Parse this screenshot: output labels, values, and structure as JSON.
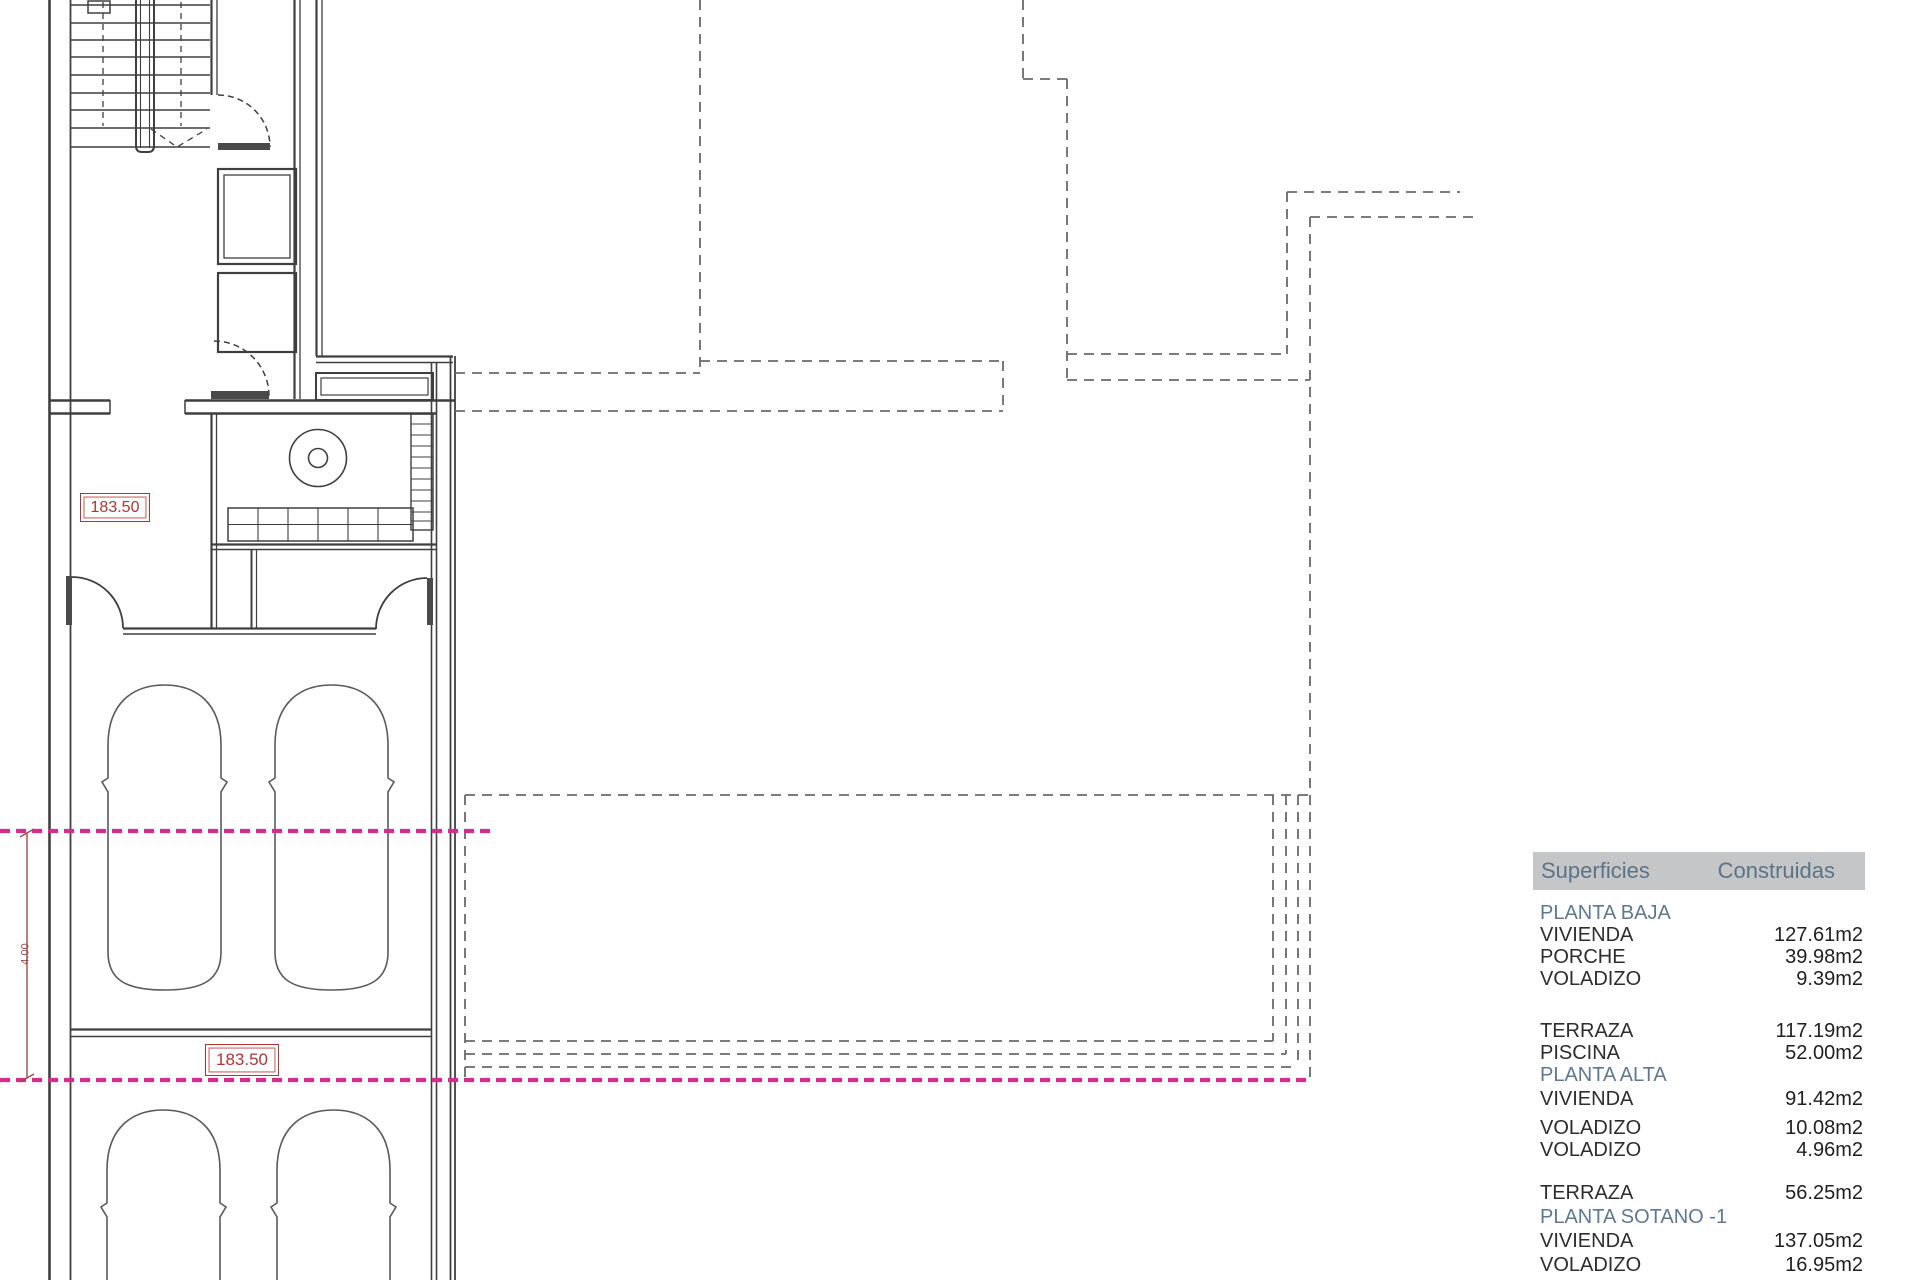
{
  "plan": {
    "labels": {
      "elevation_hall": "183.50",
      "elevation_garage": "183.50",
      "dimension_width": "4.00"
    },
    "colors": {
      "wall": "#3f3f3f",
      "dashed_outline": "#6a6a6a",
      "section_line_magenta": "#d92a8e",
      "annotation_red": "#b13434",
      "dimension_red": "#9a4b4b"
    }
  },
  "areas_table": {
    "header": {
      "surfaces": "Superficies",
      "built": "Construidas"
    },
    "style": {
      "header_bg": "#c5c6c8",
      "header_text": "#5d7286",
      "section_text": "#5f7892",
      "body_text": "#2d2d2d"
    },
    "rows": [
      {
        "type": "section",
        "label": "PLANTA BAJA"
      },
      {
        "type": "item",
        "label": "VIVIENDA",
        "value": "127.61m2"
      },
      {
        "type": "item",
        "label": "PORCHE",
        "value": "39.98m2"
      },
      {
        "type": "item",
        "label": "VOLADIZO",
        "value": "9.39m2"
      },
      {
        "type": "item",
        "label": "TERRAZA",
        "value": "117.19m2"
      },
      {
        "type": "item",
        "label": "PISCINA",
        "value": "52.00m2"
      },
      {
        "type": "section",
        "label": "PLANTA ALTA"
      },
      {
        "type": "item",
        "label": "VIVIENDA",
        "value": "91.42m2"
      },
      {
        "type": "item",
        "label": "VOLADIZO",
        "value": "10.08m2"
      },
      {
        "type": "item",
        "label": "VOLADIZO",
        "value": "4.96m2"
      },
      {
        "type": "item",
        "label": "TERRAZA",
        "value": "56.25m2"
      },
      {
        "type": "section",
        "label": "PLANTA SOTANO -1"
      },
      {
        "type": "item",
        "label": "VIVIENDA",
        "value": "137.05m2"
      },
      {
        "type": "item",
        "label": "VOLADIZO",
        "value": "16.95m2"
      }
    ]
  }
}
